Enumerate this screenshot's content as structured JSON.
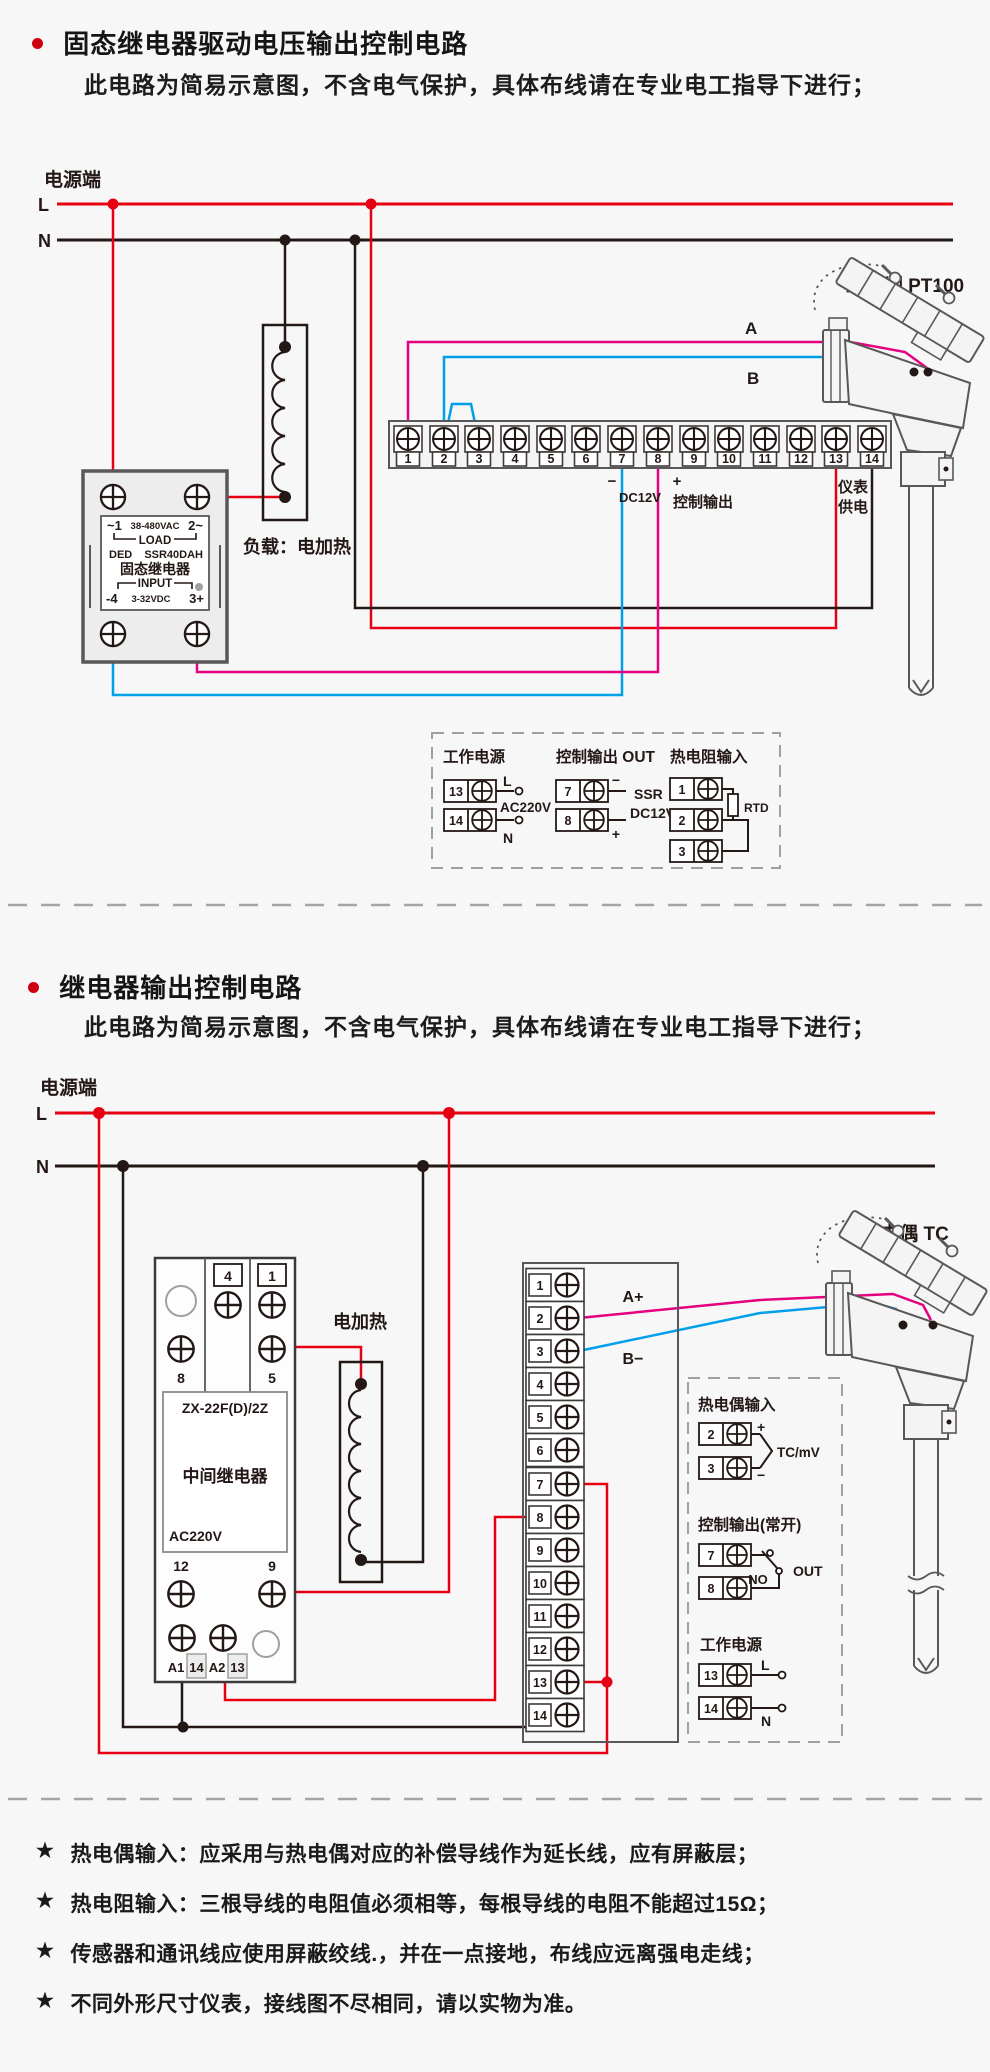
{
  "section1": {
    "title": "固态继电器驱动电压输出控制电路",
    "subtitle": "此电路为简易示意图，不含电气保护，具体布线请在专业电工指导下进行；",
    "power": {
      "label": "电源端",
      "l": "L",
      "n": "N"
    },
    "ssr": {
      "t1l": "~1",
      "t1m": "38-480VAC",
      "t1r": "2~",
      "load": "LOAD",
      "brand": "DED",
      "model": "SSR40DAH",
      "name": "固态继电器",
      "input": "INPUT",
      "t2l": "-4",
      "t2m": "3-32VDC",
      "t2r": "3+"
    },
    "load_label": "负载：电加热",
    "strip": {
      "terminals": [
        "1",
        "2",
        "3",
        "4",
        "5",
        "6",
        "7",
        "8",
        "9",
        "10",
        "11",
        "12",
        "13",
        "14"
      ]
    },
    "output": {
      "minus": "−",
      "dc": "DC12V",
      "plus": "+",
      "label": "控制输出"
    },
    "meter": {
      "l1": "仪表",
      "l2": "供电"
    },
    "sensor": {
      "label": "二线制 PT100",
      "a": "A",
      "b": "B"
    },
    "legend": {
      "power": {
        "title": "工作电源",
        "n13": "13",
        "n14": "14",
        "l": "L",
        "n": "N",
        "volt": "AC220V"
      },
      "out": {
        "title": "控制输出 OUT",
        "n7": "7",
        "n8": "8",
        "minus": "−",
        "plus": "+",
        "l1": "SSR",
        "l2": "DC12V"
      },
      "rtd": {
        "title": "热电阻输入",
        "n1": "1",
        "n2": "2",
        "n3": "3",
        "label": "RTD"
      }
    }
  },
  "section2": {
    "title": "继电器输出控制电路",
    "subtitle": "此电路为简易示意图，不含电气保护，具体布线请在专业电工指导下进行；",
    "power": {
      "label": "电源端",
      "l": "L",
      "n": "N"
    },
    "relay": {
      "n4": "4",
      "n1": "1",
      "n8": "8",
      "n5": "5",
      "model": "ZX-22F(D)/2Z",
      "name": "中间继电器",
      "volt": "AC220V",
      "n12": "12",
      "n9": "9",
      "a1": "A1",
      "n14": "14",
      "a2": "A2",
      "n13": "13"
    },
    "heater": "电加热",
    "strip": {
      "terminals": [
        "1",
        "2",
        "3",
        "4",
        "5",
        "6",
        "7",
        "8",
        "9",
        "10",
        "11",
        "12",
        "13",
        "14"
      ]
    },
    "aplus": "A+",
    "bminus": "B−",
    "sensor": {
      "label": "热电偶 TC"
    },
    "legend": {
      "tc": {
        "title": "热电偶输入",
        "n2": "2",
        "n3": "3",
        "plus": "+",
        "minus": "−",
        "label": "TC/mV"
      },
      "out": {
        "title": "控制输出(常开)",
        "n7": "7",
        "n8": "8",
        "no": "NO",
        "out": "OUT"
      },
      "power": {
        "title": "工作电源",
        "n13": "13",
        "n14": "14",
        "l": "L",
        "n": "N"
      }
    }
  },
  "notes": {
    "star": "★",
    "items": [
      "热电偶输入：应采用与热电偶对应的补偿导线作为延长线，应有屏蔽层；",
      "热电阻输入：三根导线的电阻值必须相等，每根导线的电阻不能超过15Ω；",
      "传感器和通讯线应使用屏蔽绞线.，并在一点接地，布线应远离强电走线；",
      "不同外形尺寸仪表，接线图不尽相同，请以实物为准。"
    ]
  }
}
